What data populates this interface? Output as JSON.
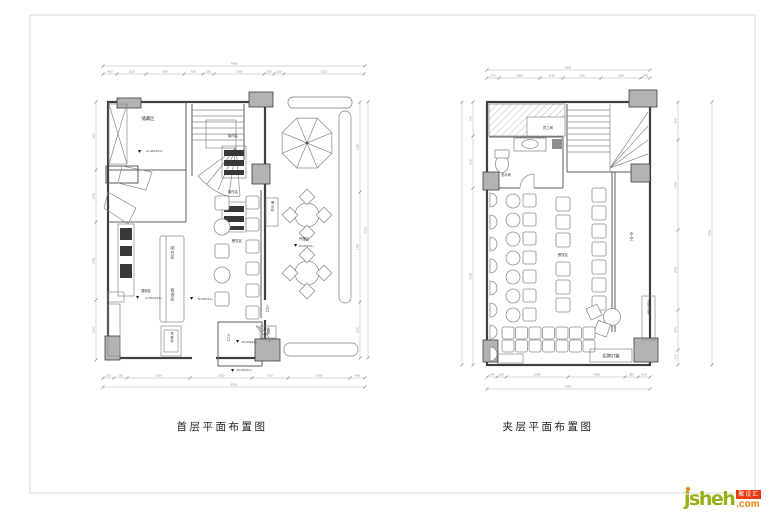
{
  "plan_first": {
    "title": "首层平面布置图",
    "rooms": {
      "storage": "储藏区",
      "work_area_1": "操作区",
      "work_area_2": "操作区",
      "mixing": "调制区",
      "bar_counter": "吧台区",
      "cashier": "收银区",
      "cake_cabinet": "蛋糕柜",
      "display_cabinet": "展示柜",
      "dining": "餐饮区",
      "outdoor": "外摆区",
      "entrance_side": "入口",
      "entrance_main": "入口",
      "prep": "备餐"
    },
    "levels": {
      "storage": "+0.260(FFL)",
      "mixing": "+0.260(FFL)",
      "dining": "±0.00(FFL)",
      "outdoor": "±0.00(FFL)",
      "entrance": "±0.00(FFL)",
      "ground": "±0.00(FFL)"
    },
    "dims": {
      "top": [
        "450",
        "1130",
        "380",
        "620",
        "250",
        "2260",
        "250",
        "200",
        "2120"
      ],
      "top_total": "7660",
      "bottom": [
        "150",
        "130",
        "3160",
        "1030",
        "620",
        "2760",
        "450"
      ],
      "bottom_total": "8300",
      "left": [
        "680",
        "2250",
        "1750",
        "2920"
      ],
      "right": [
        "2300",
        "1700",
        "850"
      ],
      "right_total": "7620"
    }
  },
  "plan_mezzanine": {
    "title": "夹层平面布置图",
    "rooms": {
      "staff": "员工间",
      "washroom": "洗手间",
      "dining": "餐饮区",
      "void": "中空",
      "lightbox_side": "招牌灯箱",
      "lightbox_bottom": "招牌灯箱"
    },
    "dims": {
      "top": [
        "240",
        "1560",
        "1140",
        "200",
        "1560",
        "240"
      ],
      "top_total": "4940",
      "bottom": [
        "240",
        "160",
        "3040",
        "1460",
        "350",
        "240"
      ],
      "bottom_total": "5490",
      "left": [
        "740",
        "620",
        "5300"
      ],
      "right": [
        "380",
        "2300",
        "1500",
        "950",
        "420"
      ],
      "right_total": "7550"
    }
  },
  "logo": {
    "name": "jsheh",
    "tld": ".com",
    "badge": "聚设汇"
  }
}
